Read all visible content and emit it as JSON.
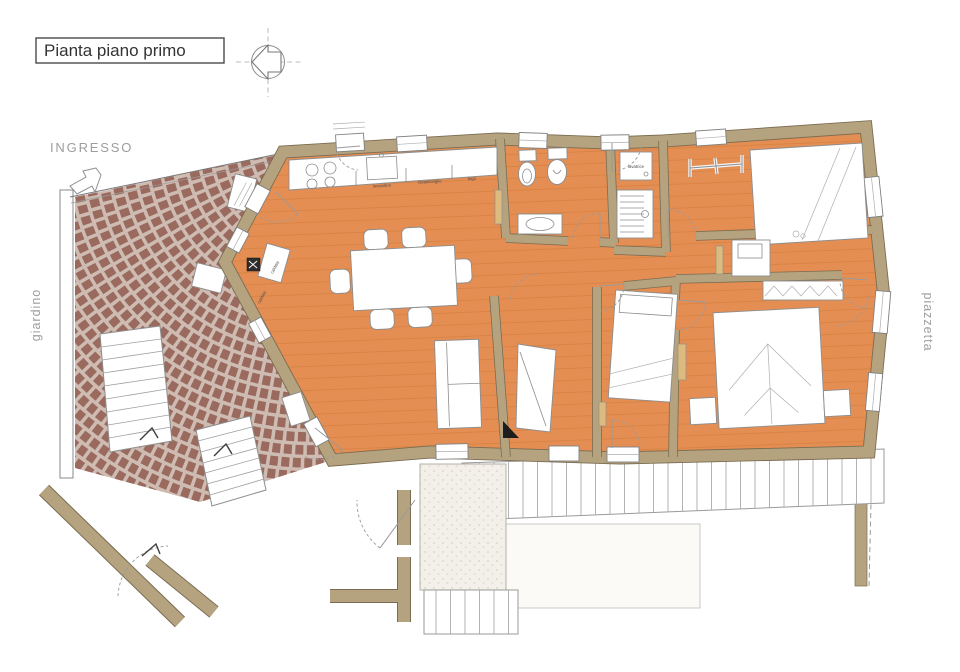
{
  "title": "Pianta piano primo",
  "labels": {
    "entrance": "INGRESSO",
    "garden": "giardino",
    "square": "piazzetta"
  },
  "fixtures": {
    "sink": "lavandino",
    "dishwasher": "lavastoviglie",
    "fridge": "frigo",
    "washer": "lavatrice",
    "boiler": "caldaia"
  },
  "colors": {
    "floor": "#E58E53",
    "plank_line": "#CF7C3C",
    "wall": "#B5A37F",
    "wall_edge": "#7A6C52",
    "brick": "#9B6A5E",
    "mortar": "#CEBCB2",
    "paper": "#FFFFFF",
    "drawing_line": "#8D8D8D",
    "radiator": "#DDBA7D"
  }
}
